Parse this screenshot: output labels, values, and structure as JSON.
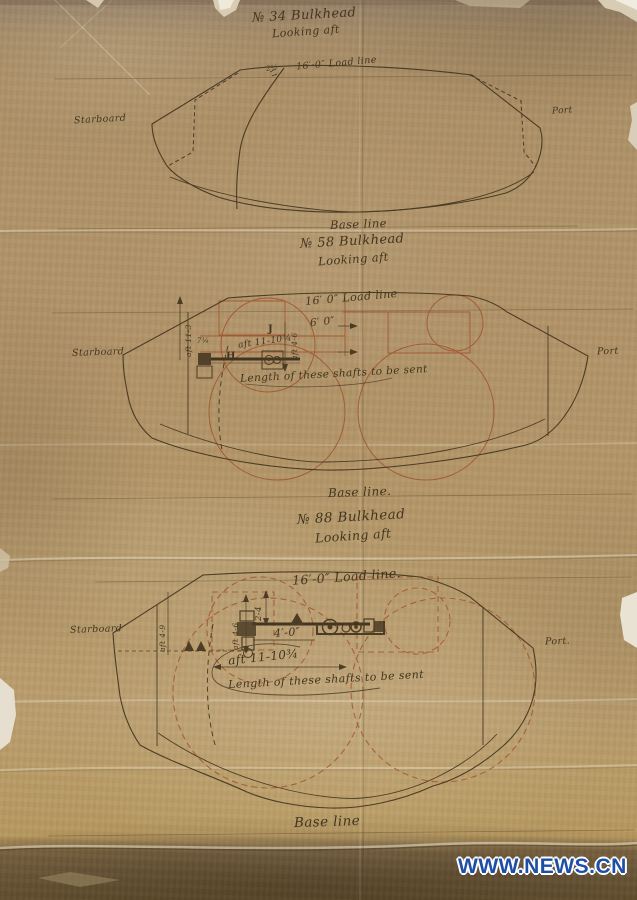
{
  "colors": {
    "paper": "#b29469",
    "ink": "#43351f",
    "red_ink": "#a0522d",
    "watermark_blue": "#1d4fa6"
  },
  "watermark": {
    "label": "WWW.NEWS.CN"
  },
  "sections": {
    "s34": {
      "title": "№ 34 Bulkhead",
      "subtitle": "Looking aft",
      "tick": "2½",
      "load_line": "16′·0″ Load line",
      "starboard": "Starboard",
      "port": "Port",
      "base_line": "Base line"
    },
    "s58": {
      "title": "№ 58 Bulkhead",
      "subtitle": "Looking aft",
      "load_line": "16′ 0″ Load line",
      "dim_6_0": "6′ 0″",
      "dim_aft": "aft 11-10¾",
      "dim_small": "7¼",
      "label_j": "J",
      "label_h": "H",
      "dim_vert_left": "aft 11-3",
      "dim_vert_right": "aft 4-6",
      "note": "Length of these shafts to be sent",
      "starboard": "Starboard",
      "port": "Port",
      "base_line": "Base line."
    },
    "s88": {
      "title": "№ 88 Bulkhead",
      "subtitle": "Looking aft",
      "load_line": "16′-0″ Load line.",
      "dim_2_4": "2-4",
      "dim_4_0": "4′-0″",
      "dim_aft": "aft 11-10¾",
      "dim_vert_left": "aft 4-9",
      "dim_vert_mid": "aft 4-6",
      "note": "Length of these shafts to be sent",
      "starboard": "Starboard",
      "port": "Port.",
      "base_line": "Base line"
    }
  }
}
